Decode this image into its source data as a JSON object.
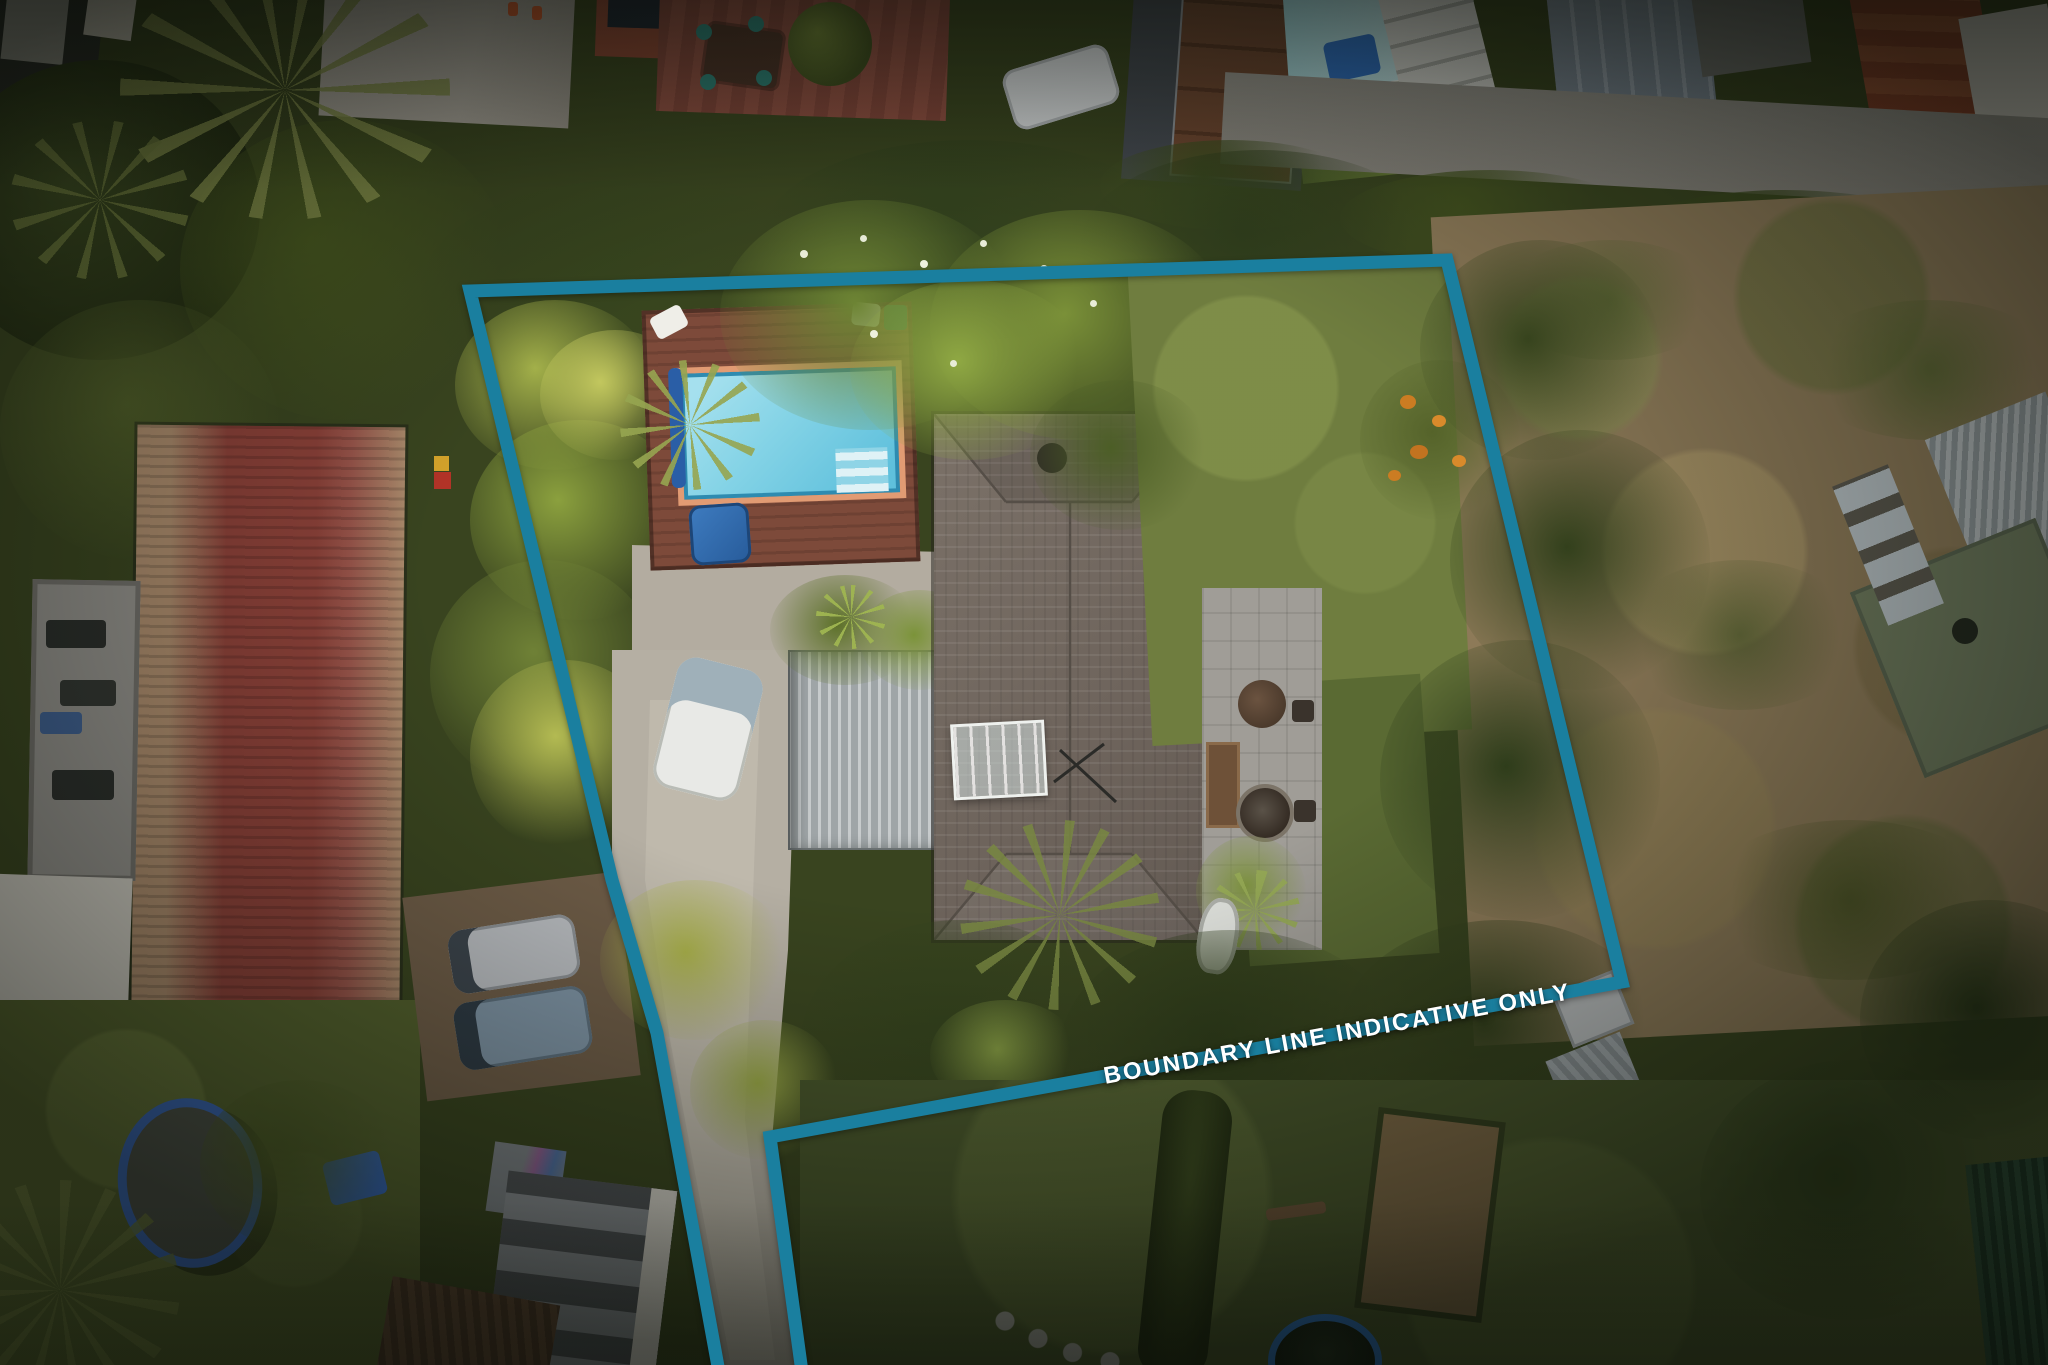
{
  "photo": {
    "kind": "aerial-drone-photo-of-residential-property",
    "features": [
      "swimming-pool",
      "pool-deck",
      "spa-cover",
      "main-house-tiled-roof",
      "garage-metal-roof",
      "caravan",
      "concrete-driveway",
      "backyard-lawn",
      "flowering-orange-tree",
      "patio-furniture",
      "greenhouse",
      "red-iron-roof-building",
      "rooftop-deck",
      "trampoline",
      "blue-tarp",
      "parked-cars",
      "neighbouring-dirt-field",
      "neighbour-cottage",
      "garden-sheds",
      "round-pool",
      "stepping-stones",
      "street-footpath",
      "tree-canopy"
    ]
  },
  "boundary": {
    "label": "BOUNDARY LINE INDICATIVE ONLY",
    "line_color": "#1a7f9f",
    "label_color": "#ffffff",
    "points": "470,291 1447,260 1622,982 770,1137 802,1372 719,1372 657,1033 612,880"
  }
}
